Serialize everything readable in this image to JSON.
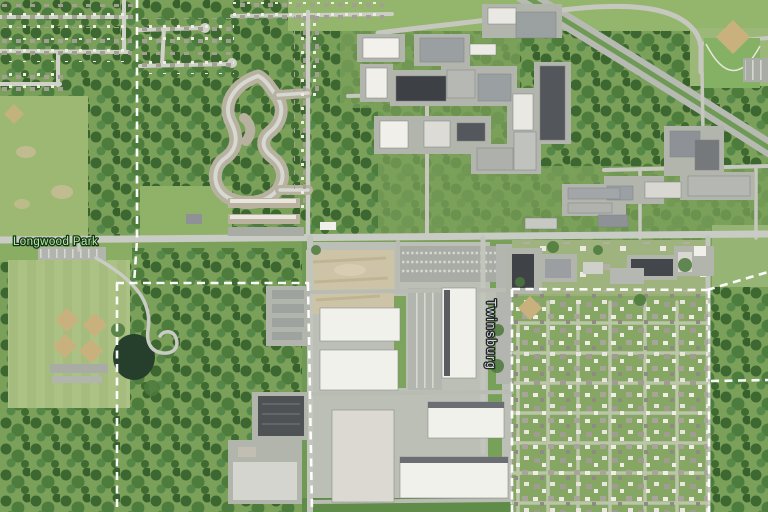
{
  "map": {
    "view_type": "satellite-imagery",
    "labels": {
      "park": {
        "text": "Longwood Park",
        "color": "#b4ef9e"
      },
      "road": {
        "text": "Twinsburg",
        "color": "#d4d7d9",
        "orientation": "vertical"
      }
    },
    "boundary": {
      "style": "dashed",
      "color": "#ffffff"
    },
    "palette": {
      "base_green": "#7ba05a",
      "forest": "#44713a",
      "field": "#9cb873",
      "road": "#c6c8c0",
      "warehouse_roof": "#f1f1ec",
      "dark_roof": "#3d4145",
      "dirt_lot": "#cdc3a7",
      "ball_infield": "#c9b17e",
      "pond": "#263f2d"
    }
  }
}
